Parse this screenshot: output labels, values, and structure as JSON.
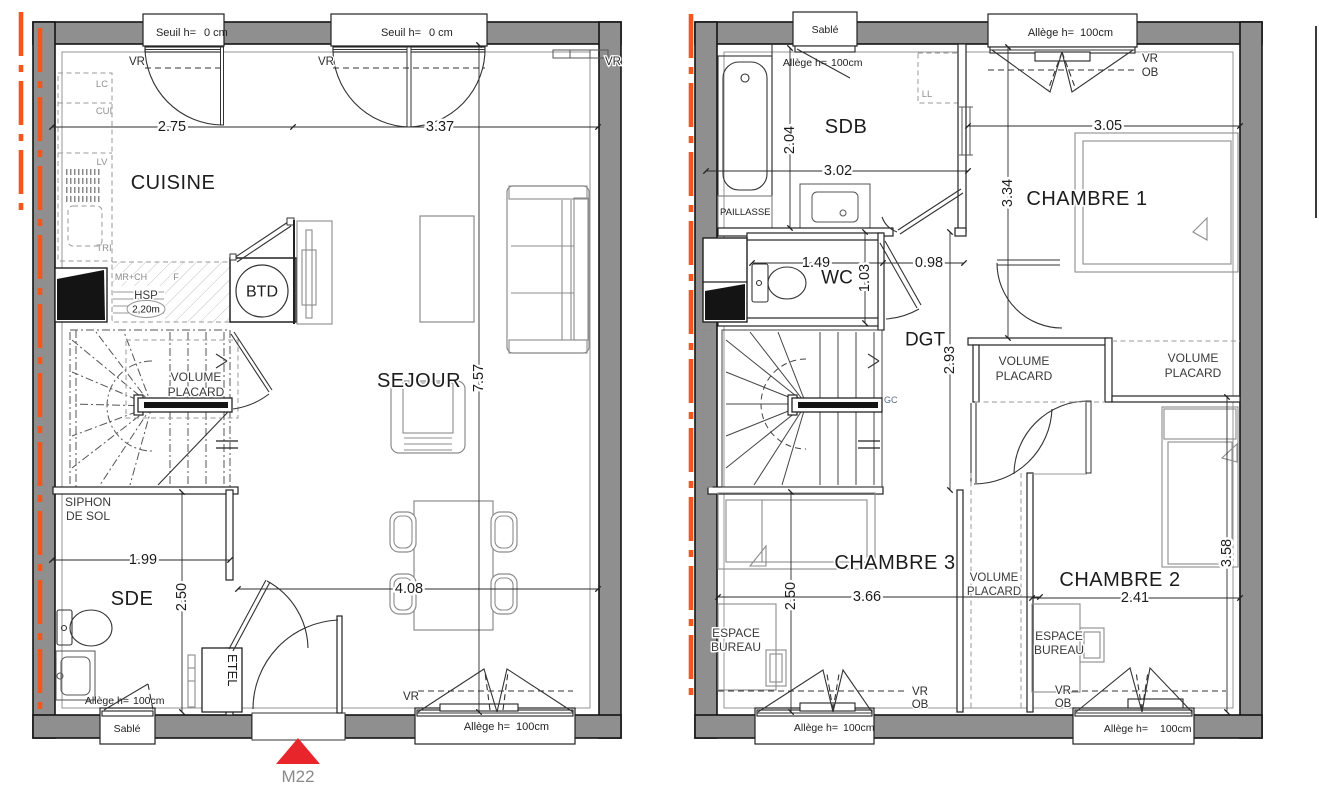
{
  "shared": {
    "vr": "VR",
    "ob": "OB",
    "sable": "Sablé",
    "seuil_label": "Seuil h=",
    "seuil_value": "0 cm",
    "allege_label": "Allège h=",
    "allege_value": "100cm",
    "volume": "VOLUME",
    "placard": "PLACARD",
    "espace": "ESPACE",
    "bureau": "BUREAU"
  },
  "ground_floor": {
    "rooms": {
      "cuisine": "CUISINE",
      "sejour": "SEJOUR",
      "sde": "SDE"
    },
    "kitchen_units": {
      "lc": "LC",
      "cui": "CUI",
      "lv": "LV",
      "tri": "TRI",
      "mr_ch": "MR+CH",
      "f": "F"
    },
    "annotations": {
      "hsp": "HSP",
      "hsp_value": "2,20m",
      "btd": "BTD",
      "siphon_line1": "SIPHON",
      "siphon_line2": "DE SOL",
      "etel": "ETEL"
    },
    "dimensions": {
      "cuisine_width": "2.75",
      "sejour_width": "3.37",
      "depth": "7.57",
      "sde_width": "1.99",
      "sde_height": "2.50",
      "sejour_length": "4.08"
    },
    "entrance_door": "M22"
  },
  "upper_floor": {
    "rooms": {
      "sdb": "SDB",
      "wc": "WC",
      "dgt": "DGT",
      "chambre1": "CHAMBRE 1",
      "chambre2": "CHAMBRE 2",
      "chambre3": "CHAMBRE 3"
    },
    "annotations": {
      "paillasse": "PAILLASSE",
      "ll": "LL",
      "gc": "GC"
    },
    "dimensions": {
      "sdb_height": "2.04",
      "sdb_width": "3.02",
      "ch1_width": "3.05",
      "ch1_height": "3.34",
      "wc_width": "1.49",
      "wc_height": "1.03",
      "dgt_width": "0.98",
      "dgt_height": "2.93",
      "ch3_height": "2.50",
      "ch3_width": "3.66",
      "ch2_width": "2.41",
      "ch2_height": "3.58"
    }
  },
  "colors": {
    "wall_fill": "#8f8f8f",
    "outline": "#141414",
    "accent_line": "#f4571d",
    "entrance_marker": "#e8252b",
    "dim_text": "#1c1c1c"
  }
}
